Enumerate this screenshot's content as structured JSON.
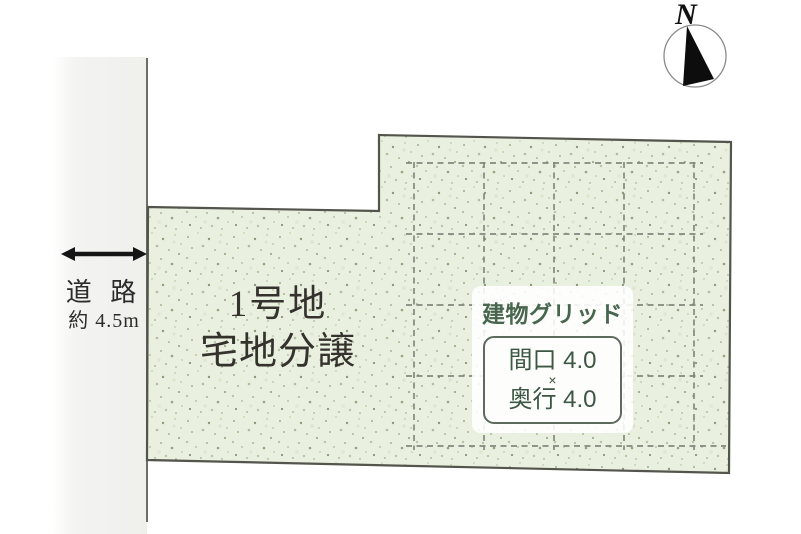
{
  "road": {
    "name_label": "道 路",
    "width_label": "約 4.5m"
  },
  "plot": {
    "title": "1号地",
    "subtitle": "宅地分譲"
  },
  "building_grid": {
    "title": "建物グリッド",
    "frontage": "間口 4.0",
    "times": "×",
    "depth": "奥行 4.0"
  },
  "compass": {
    "north_label": "N"
  },
  "colors": {
    "plot_fill": "#eaf0e0",
    "plot_border": "#53544b",
    "grid_line": "#7d8376",
    "accent_green": "#48664e",
    "road_fill": "#f1f1ef",
    "compass_black": "#0d0d0d"
  }
}
